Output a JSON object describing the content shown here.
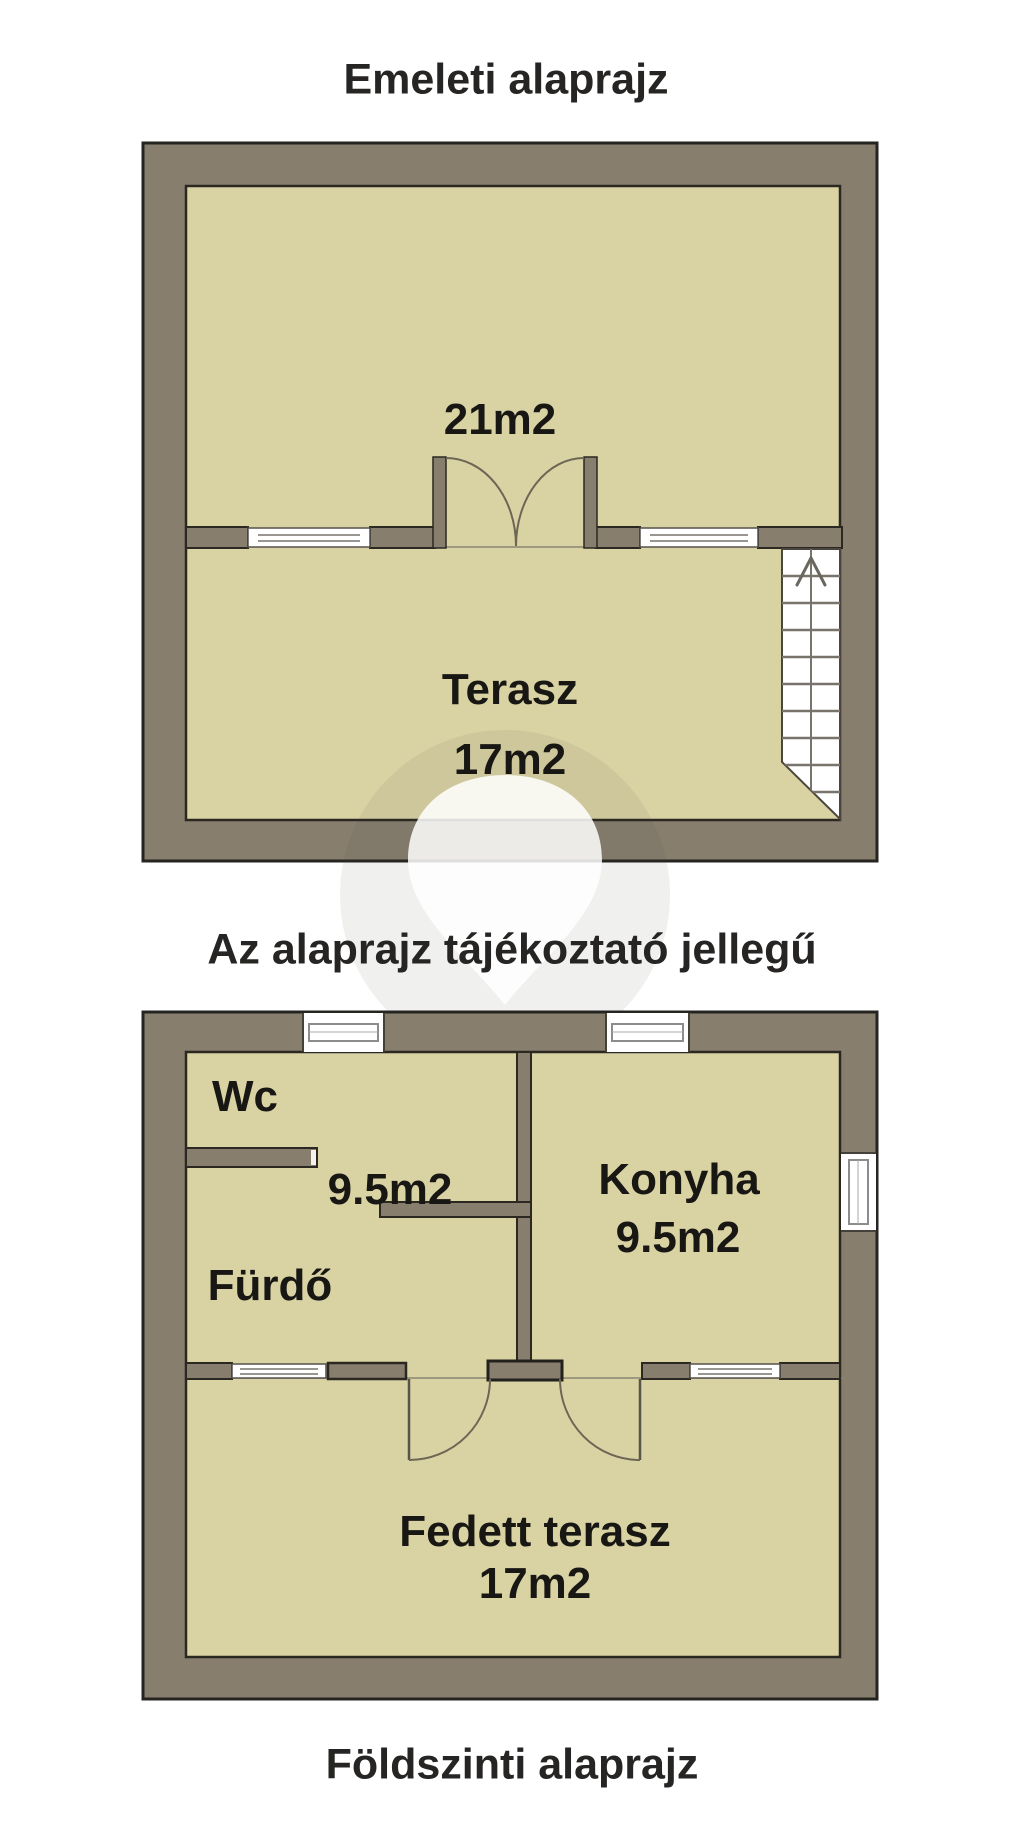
{
  "palette": {
    "background": "#ffffff",
    "wall_fill": "#877e6e",
    "wall_outline": "#2b2822",
    "floor_fill": "#d9d3a4",
    "window_fill": "#ffffff",
    "window_glass_line": "#999692",
    "door_arc": "#6e6655",
    "stair_line": "#78746c",
    "text_color": "#1d1b18",
    "watermark_circle": "rgba(70,65,45,0.08)"
  },
  "upper_plan": {
    "title": "Emeleti alaprajz",
    "room_area_label": "21m2",
    "terrace_label": "Terasz",
    "terrace_area_label": "17m2"
  },
  "disclaimer": "Az alaprajz tájékoztató jellegű",
  "lower_plan": {
    "title": "Földszinti alaprajz",
    "wc_label": "Wc",
    "bathroom_area_label": "9.5m2",
    "bathroom_label": "Fürdő",
    "kitchen_label": "Konyha",
    "kitchen_area_label": "9.5m2",
    "terrace_label": "Fedett terasz",
    "terrace_area_label": "17m2"
  }
}
